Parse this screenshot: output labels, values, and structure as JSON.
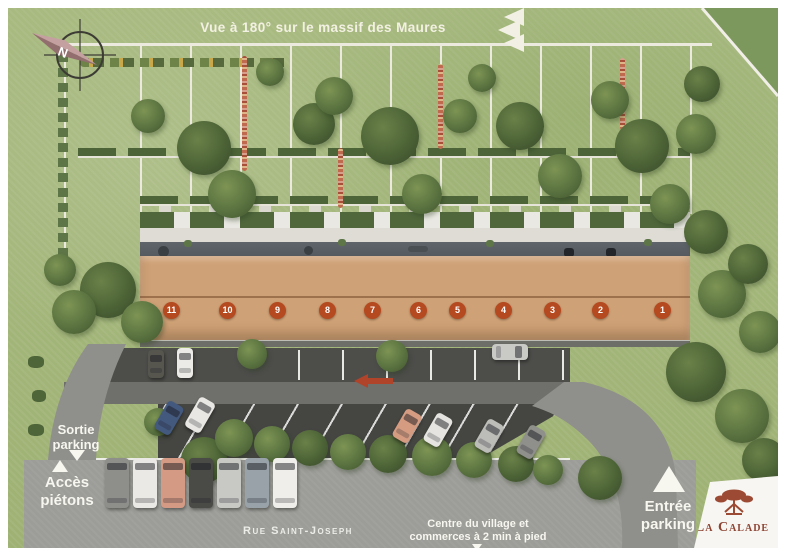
{
  "banner": {
    "text": "Vue à 180° sur le massif des Maures"
  },
  "compass": {
    "north": "N"
  },
  "building": {
    "units": [
      "11",
      "10",
      "9",
      "8",
      "7",
      "6",
      "5",
      "4",
      "3",
      "2",
      "1"
    ]
  },
  "labels": {
    "sortie_parking": "Sortie\nparking",
    "acces_pietons": "Accès\npiétons",
    "entree_parking": "Entrée\nparking",
    "street_name": "Rue Saint-Joseph",
    "village_info": "Centre du village et\ncommerces à 2 min à pied"
  },
  "logo": {
    "name": "La Calade"
  },
  "colors": {
    "unit_badge_red": "#b5491f",
    "logo_red": "#8d4433",
    "direction_arrow_red": "#b0442b",
    "roof_tile": "#cfa176",
    "grass_green": "#a3b57c"
  }
}
